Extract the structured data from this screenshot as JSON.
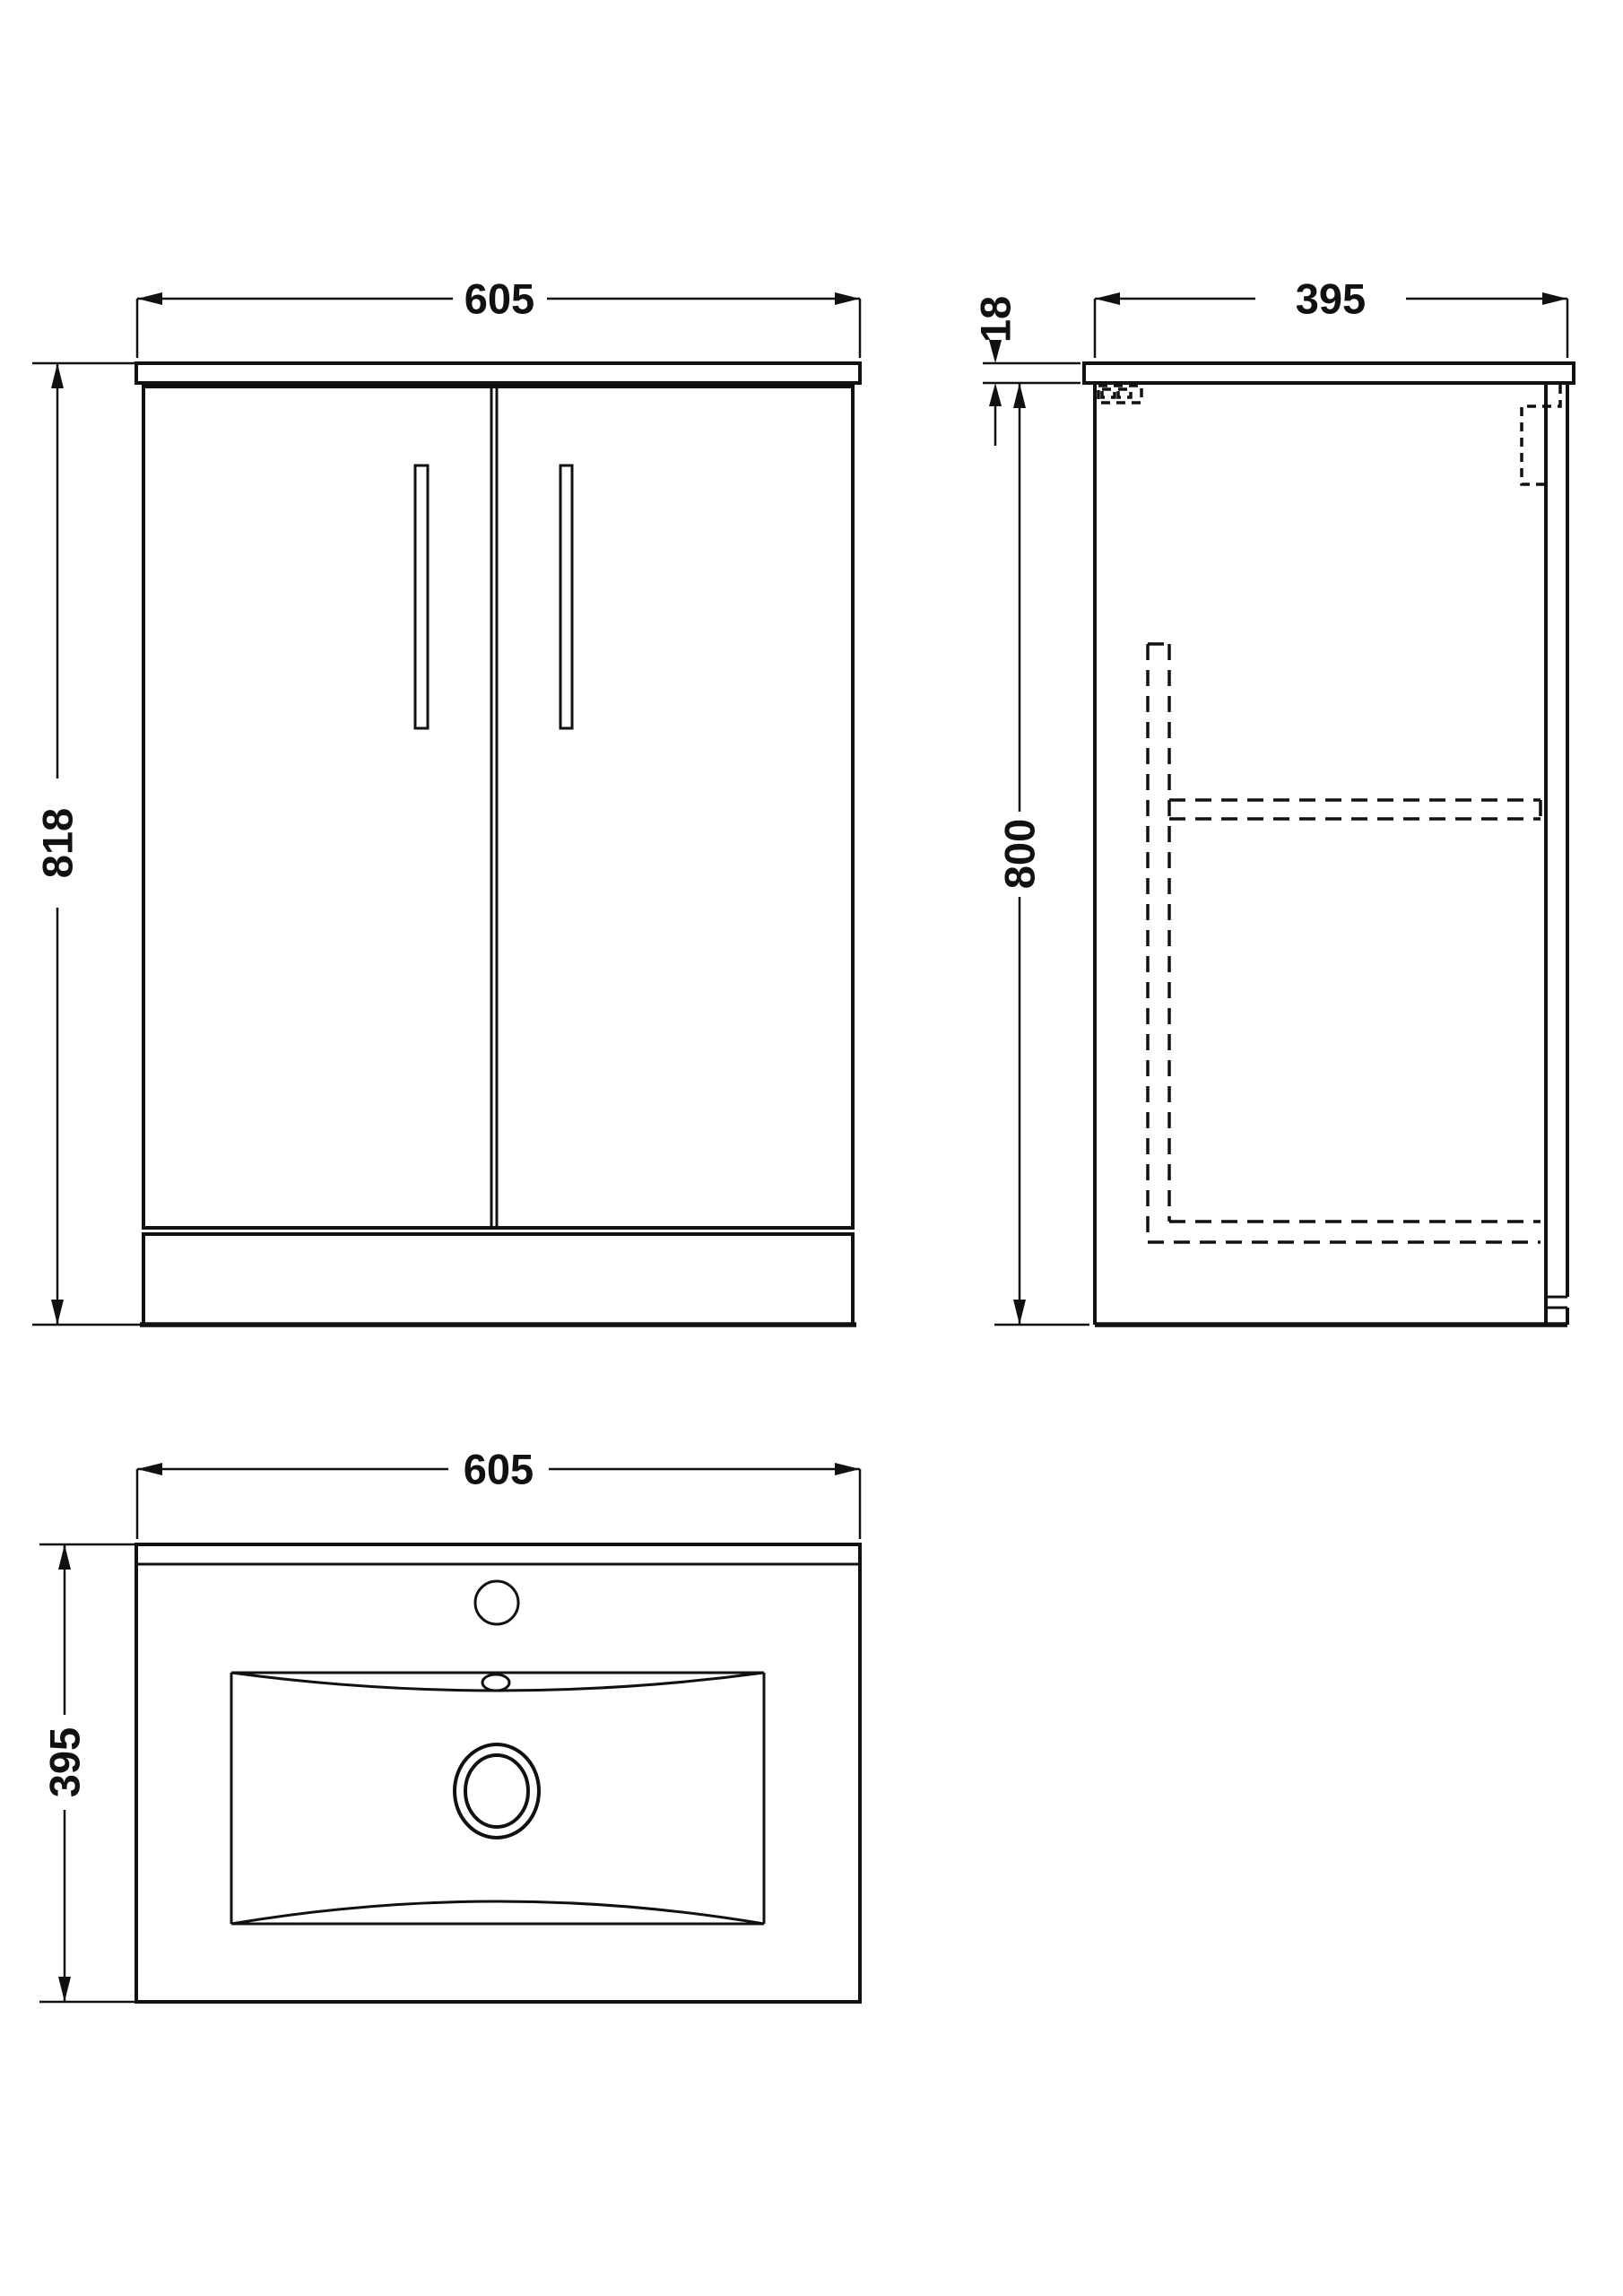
{
  "drawing": {
    "front_view": {
      "width_label": "605",
      "height_label": "818"
    },
    "side_view": {
      "depth_label": "395",
      "worktop_thickness_label": "18",
      "carcass_height_label": "800"
    },
    "plan_view": {
      "width_label": "605",
      "depth_label": "395"
    }
  },
  "colors": {
    "line": "#111111",
    "background": "#ffffff"
  }
}
